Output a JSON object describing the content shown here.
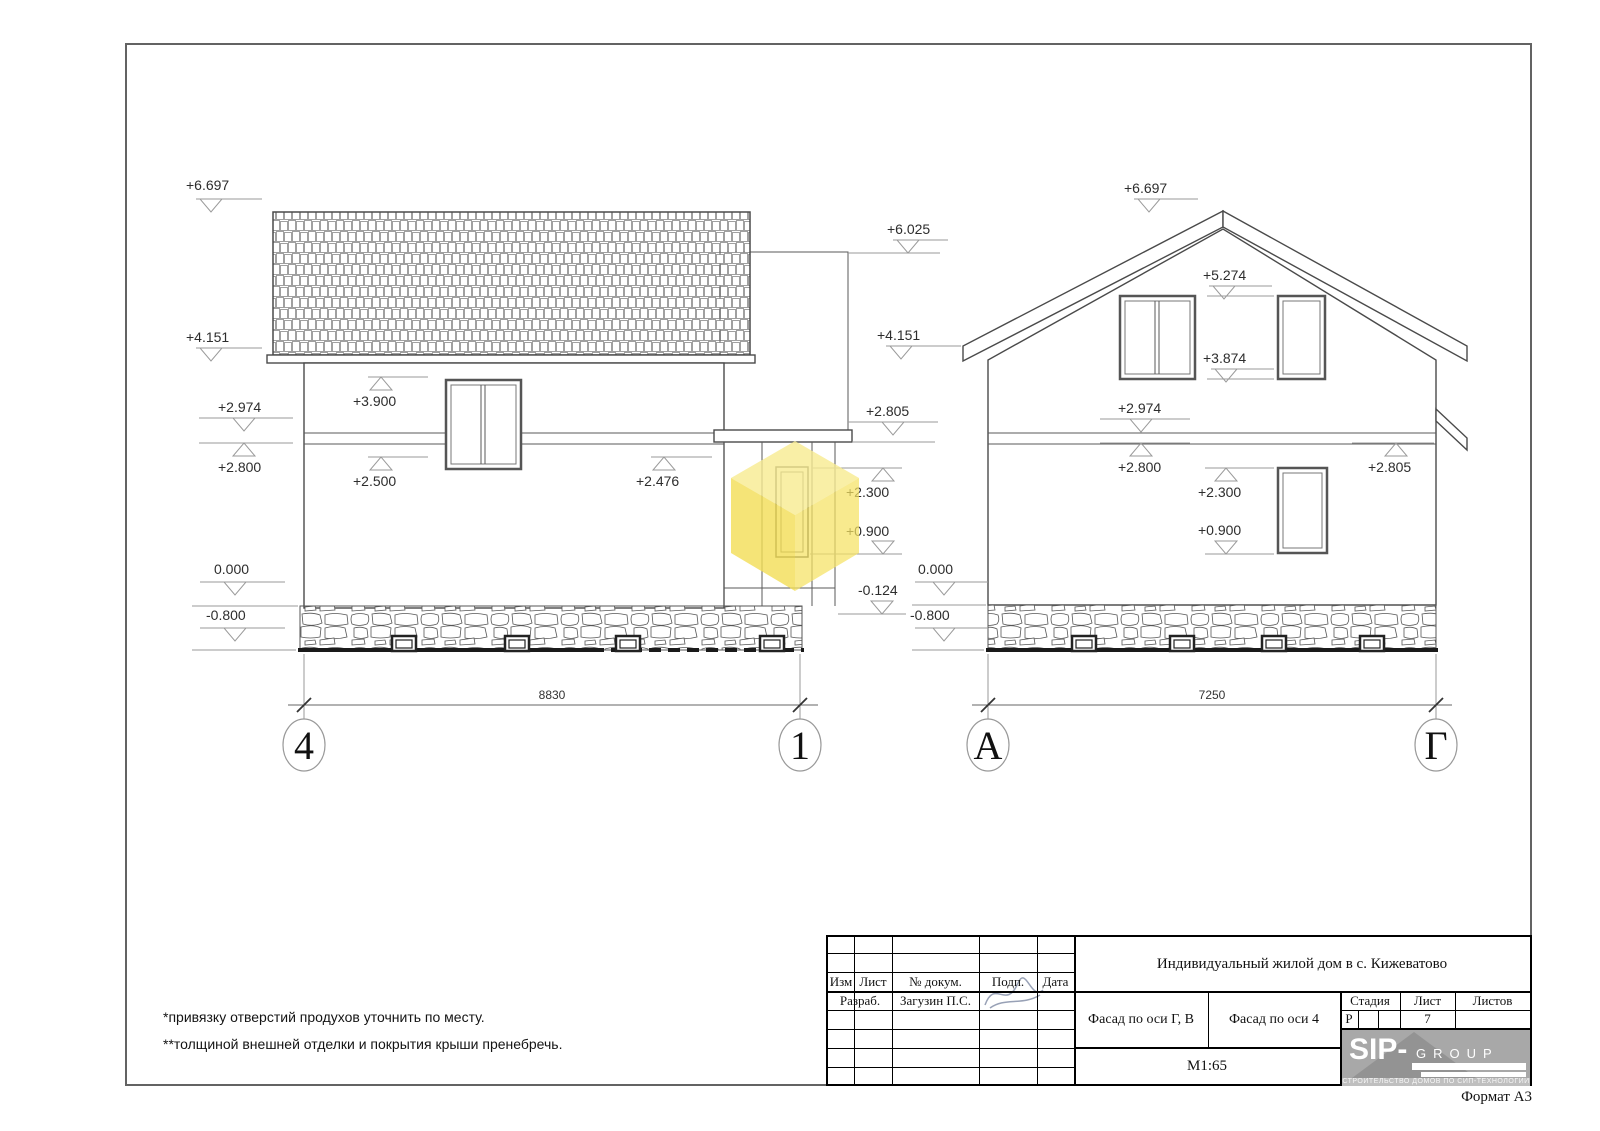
{
  "frame": {
    "format_label": "Формат А3"
  },
  "notes": {
    "line1": "*привязку отверстий продухов уточнить по месту.",
    "line2": "**толщиной внешней отделки и покрытия крыши пренебречь."
  },
  "left_facade": {
    "dimension": "8830",
    "axis_left": "4",
    "axis_right": "1",
    "marks": {
      "m6697": "+6.697",
      "m4151": "+4.151",
      "m2974": "+2.974",
      "m2800": "+2.800",
      "m0000": "0.000",
      "m0800n": "-0.800",
      "m3900": "+3.900",
      "m2500": "+2.500",
      "m2476": "+2.476",
      "m6025": "+6.025",
      "m4151r": "+4.151",
      "m2805": "+2.805",
      "m2300": "+2.300",
      "m0900": "+0.900",
      "m0124n": "-0.124"
    }
  },
  "right_facade": {
    "dimension": "7250",
    "axis_left": "А",
    "axis_right": "Г",
    "marks": {
      "m6697": "+6.697",
      "m5274": "+5.274",
      "m3874": "+3.874",
      "m2974": "+2.974",
      "m2800": "+2.800",
      "m2805": "+2.805",
      "m2300": "+2.300",
      "m0900": "+0.900",
      "m0000": "0.000",
      "m0800n": "-0.800"
    }
  },
  "title_block": {
    "project_title": "Индивидуальный жилой дом в с. Кижеватово",
    "col_izm": "Изм",
    "col_list": "Лист",
    "col_doc": "№ докум.",
    "col_sign": "Подп.",
    "col_date": "Дата",
    "developer_label": "Разраб.",
    "developer_name": "Загузин П.С.",
    "sheet_title_1": "Фасад по оси Г, В",
    "sheet_title_2": "Фасад по оси 4",
    "stage_label": "Стадия",
    "sheet_label": "Лист",
    "sheets_label": "Листов",
    "stage_value": "Р",
    "sheet_value": "7",
    "scale": "М1:65",
    "logo_brand": "SIP-",
    "logo_brand2": "GROUP",
    "logo_tagline": "СТРОИТЕЛЬСТВО ДОМОВ ПО СИП-ТЕХНОЛОГИИ"
  },
  "colors": {
    "cube_top": "#f7eb90",
    "cube_left": "#f2dd55",
    "cube_right": "#f5e263",
    "line_main": "#4a4a4a",
    "line_marks": "#9a9a9a",
    "logo_bg": "#a8a8a8"
  }
}
